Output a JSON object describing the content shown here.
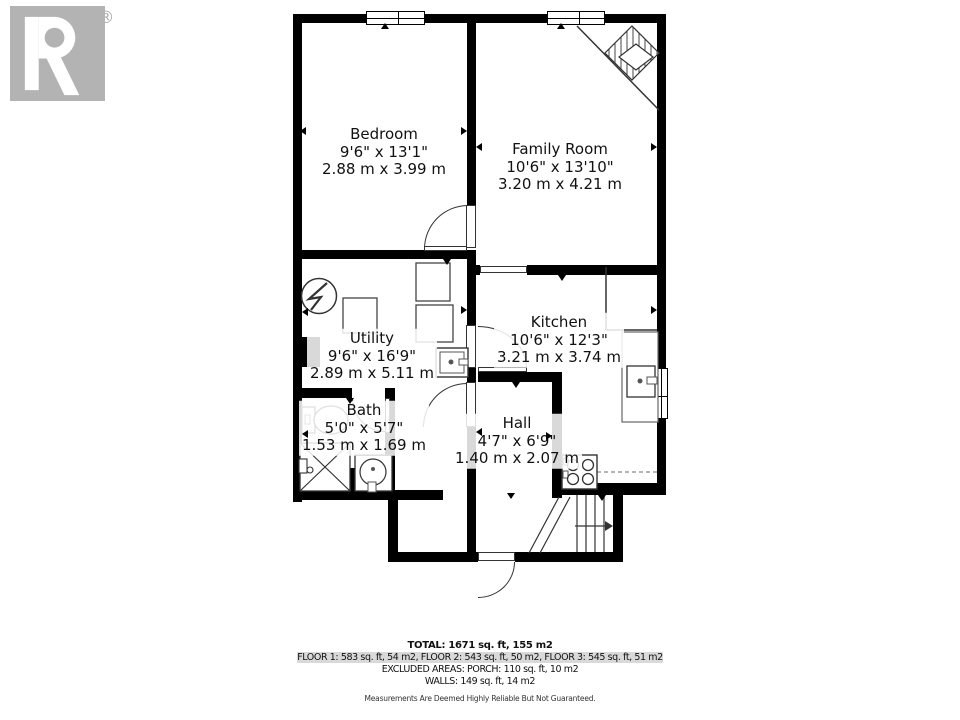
{
  "branding": {
    "logo_text": "REALTOR®"
  },
  "rooms": [
    {
      "name": "Bedroom",
      "imperial": "9'6\" x 13'1\"",
      "metric": "2.88 m x 3.99 m"
    },
    {
      "name": "Family Room",
      "imperial": "10'6\" x 13'10\"",
      "metric": "3.20 m x 4.21 m"
    },
    {
      "name": "Utility",
      "imperial": "9'6\" x 16'9\"",
      "metric": "2.89 m x 5.11 m"
    },
    {
      "name": "Kitchen",
      "imperial": "10'6\" x 12'3\"",
      "metric": "3.21 m x 3.74 m"
    },
    {
      "name": "Bath",
      "imperial": "5'0\" x 5'7\"",
      "metric": "1.53 m x 1.69 m"
    },
    {
      "name": "Hall",
      "imperial": "4'7\" x 6'9\"",
      "metric": "1.40 m x 2.07 m"
    }
  ],
  "summary": {
    "total": "TOTAL: 1671 sq. ft, 155 m2",
    "floors": "FLOOR 1: 583 sq. ft, 54 m2, FLOOR 2: 543 sq. ft, 50 m2, FLOOR 3: 545 sq. ft, 51 m2",
    "excluded": "EXCLUDED AREAS: PORCH: 110 sq. ft, 10 m2",
    "walls": "WALLS: 149 sq. ft, 14 m2",
    "disclaimer": "Measurements Are Deemed Highly Reliable But Not Guaranteed."
  },
  "colors": {
    "wall": "#000000",
    "logo_gray": "#b3b3b3",
    "text": "#111111"
  }
}
